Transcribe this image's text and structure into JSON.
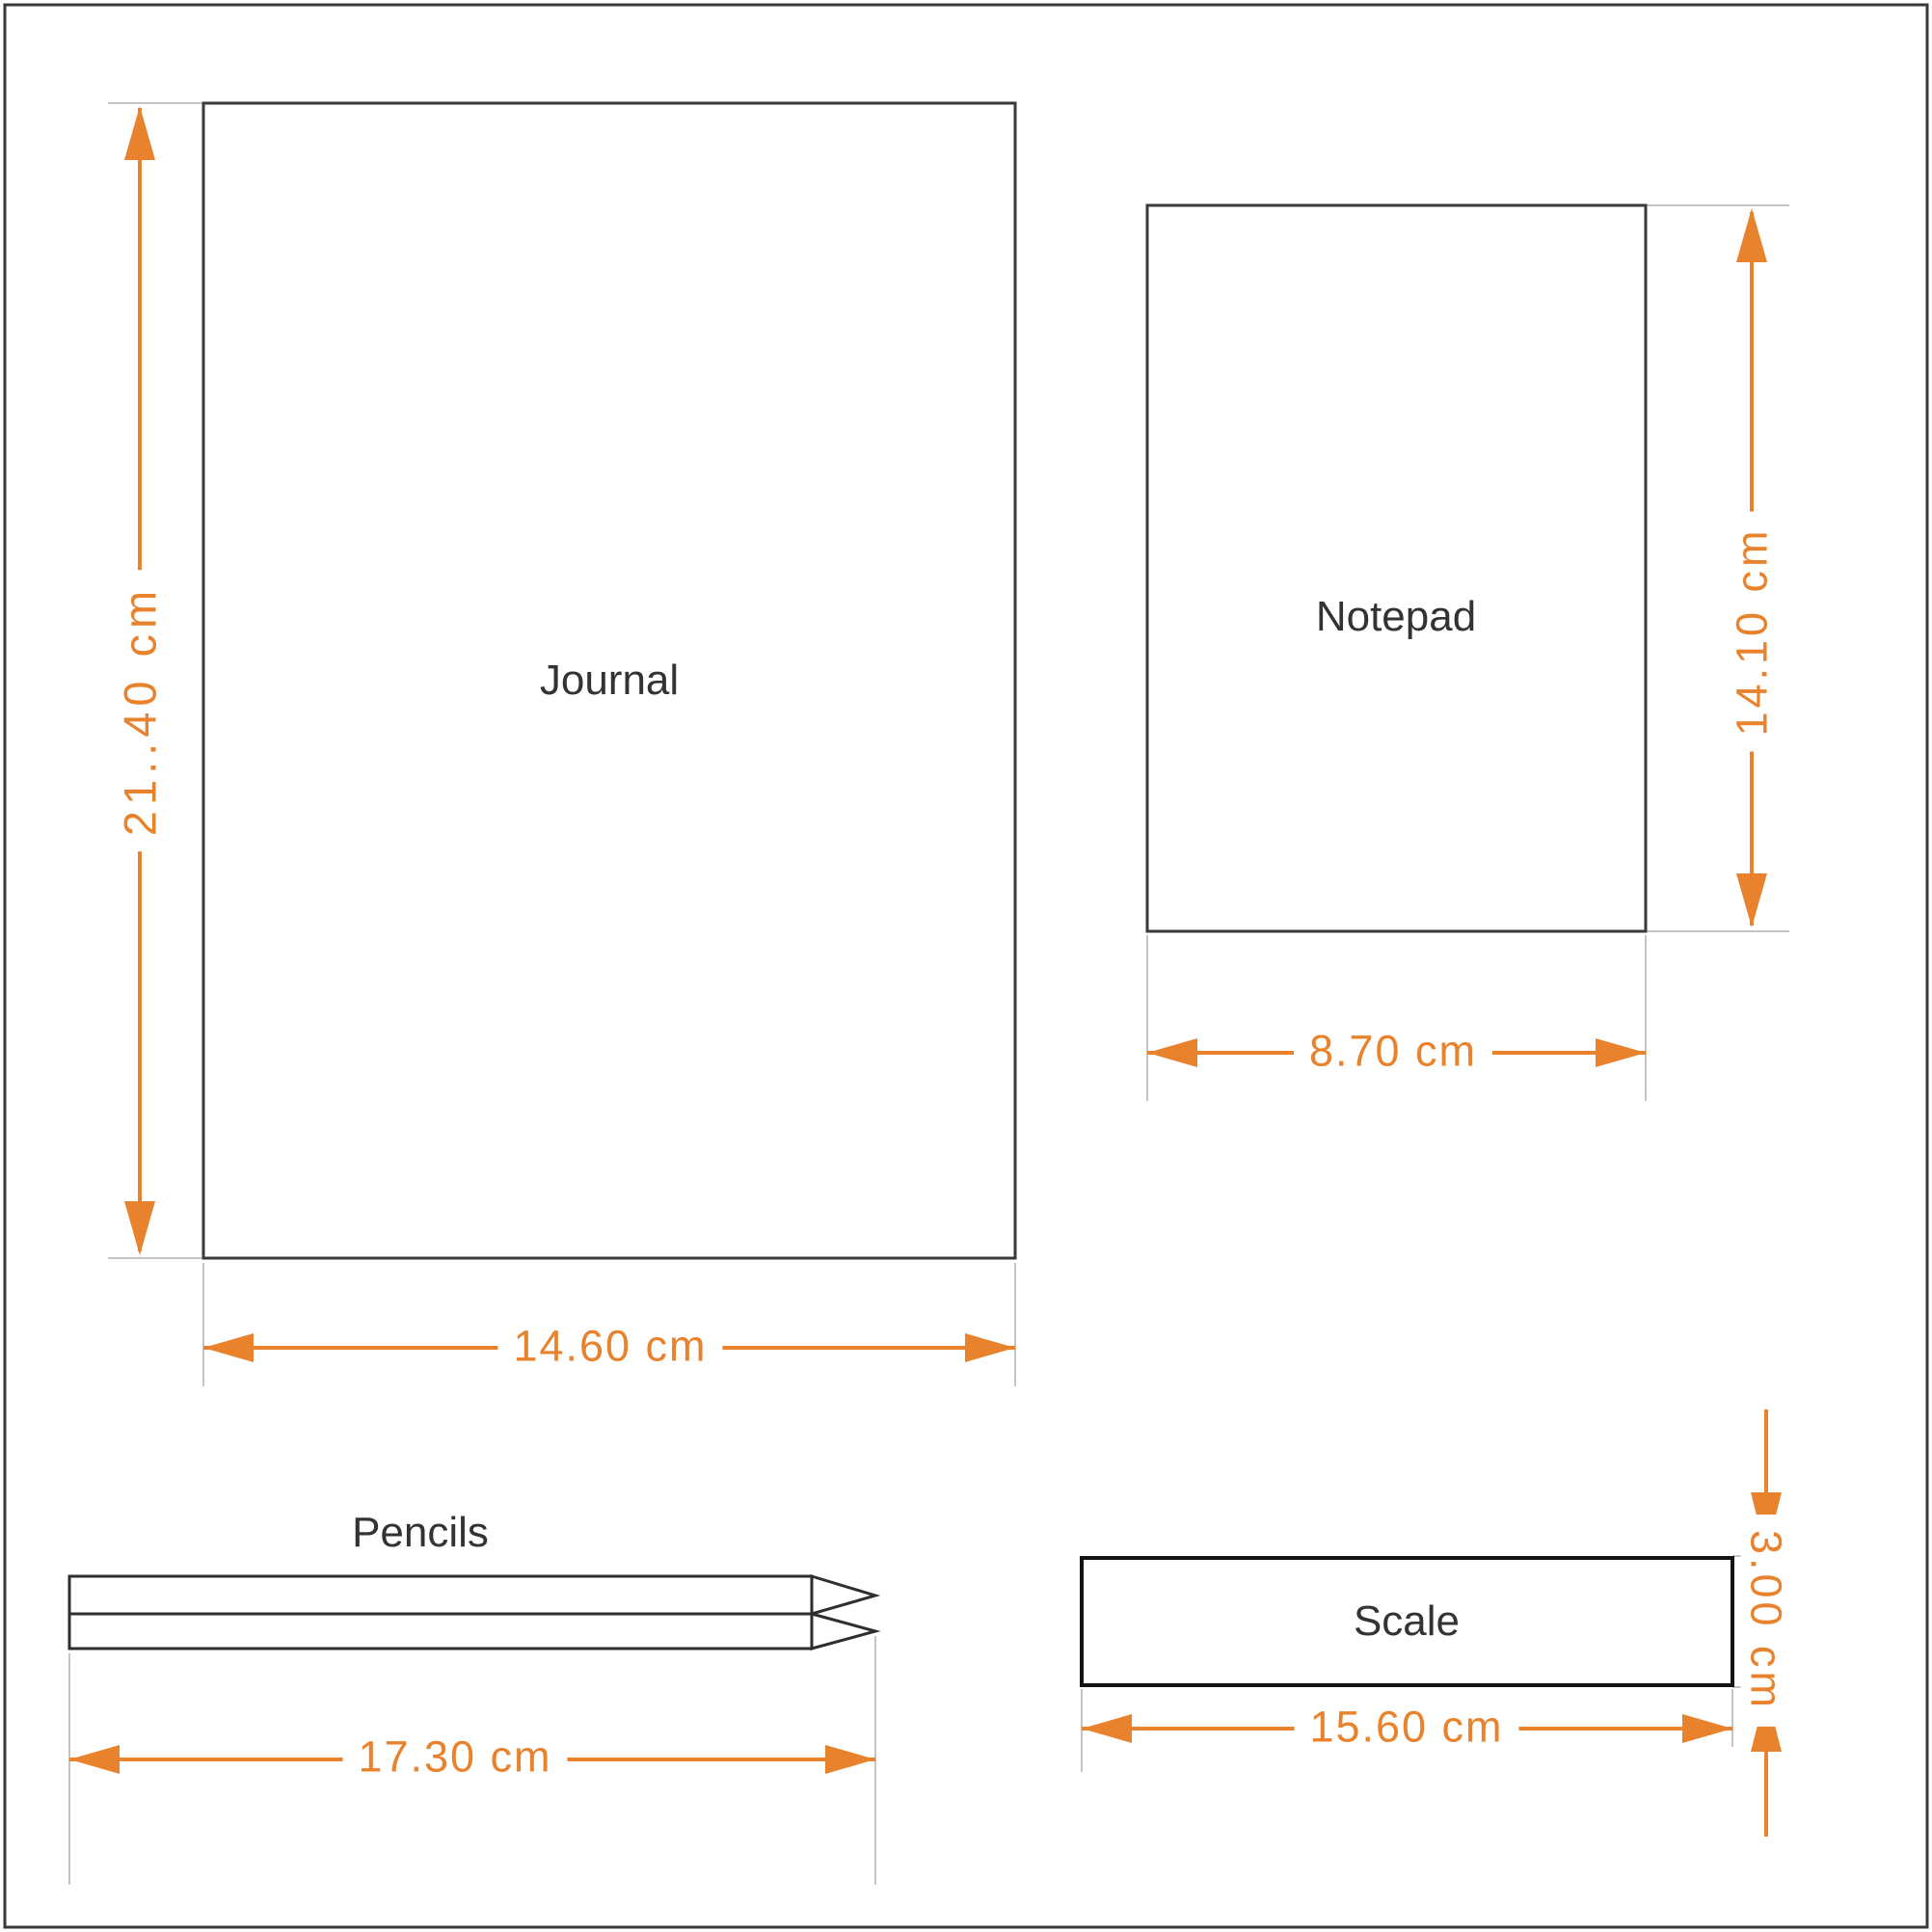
{
  "drawing": {
    "type": "dimension-drawing",
    "unit": "cm",
    "colors": {
      "accent_orange": "#e8822c",
      "outline_dark": "#343434",
      "scale_outline": "#141414",
      "extension_gray": "#c4c4c4",
      "label_text": "#333333",
      "background": "#ffffff"
    },
    "objects": {
      "journal": {
        "label": "Journal",
        "height_label": "21..40 cm",
        "width_label": "14.60 cm"
      },
      "notepad": {
        "label": "Notepad",
        "height_label": "14.10 cm",
        "width_label": "8.70 cm"
      },
      "pencils": {
        "label": "Pencils",
        "length_label": "17.30 cm"
      },
      "scale": {
        "label": "Scale",
        "height_label": "3.00 cm",
        "width_label": "15.60 cm"
      }
    }
  }
}
